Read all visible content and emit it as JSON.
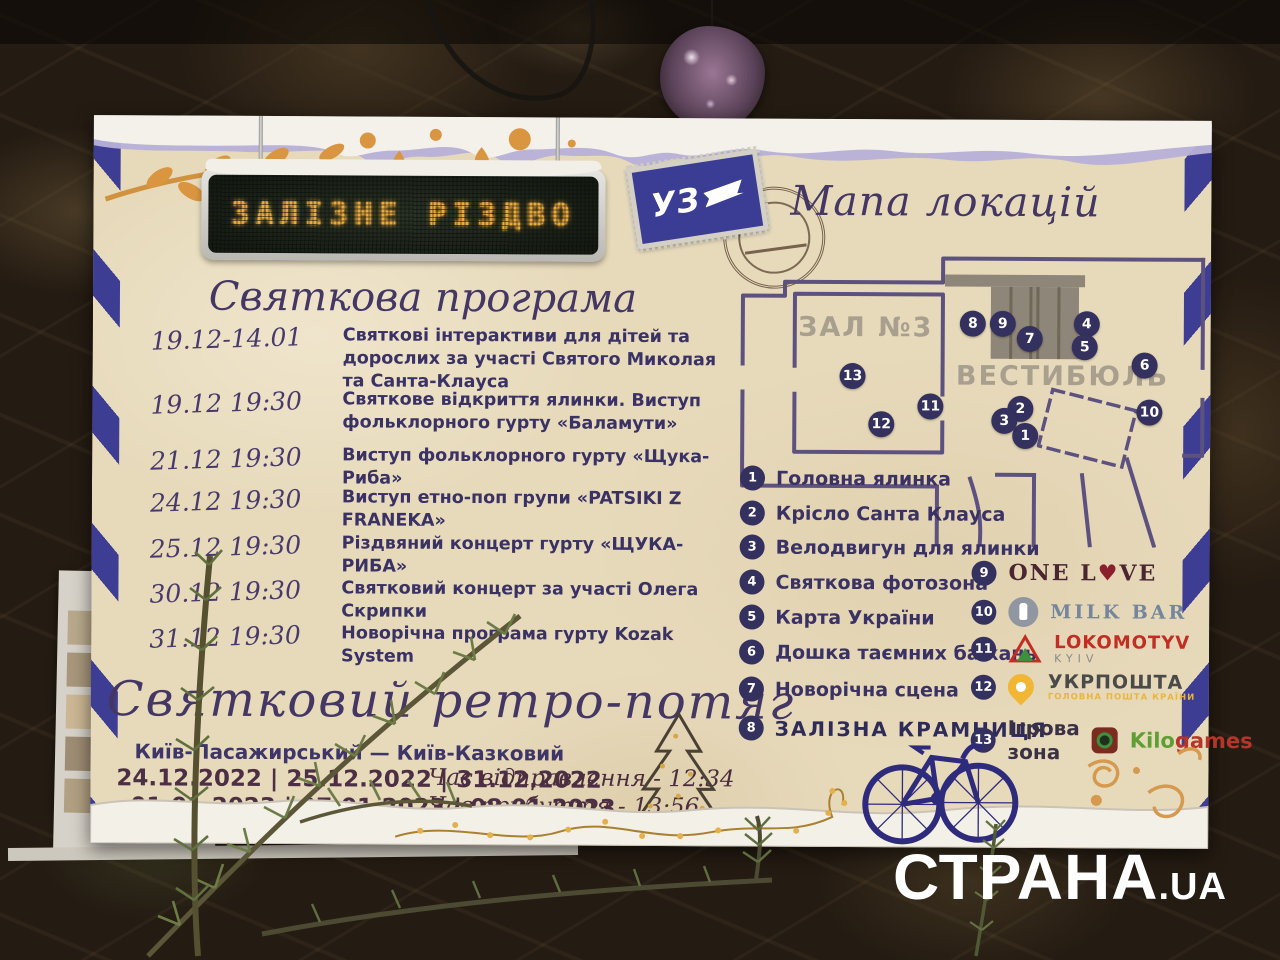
{
  "led_sign": {
    "text": "ЗАЛІЗНЕ РІЗДВО"
  },
  "stamp": {
    "label": "УЗ"
  },
  "map": {
    "title": "Мапа локацій",
    "hall_label": "ЗАЛ №3",
    "vestibule_label": "ВЕСТИБЮЛЬ",
    "markers": [
      "1",
      "2",
      "3",
      "4",
      "5",
      "6",
      "7",
      "8",
      "9",
      "10",
      "11",
      "12",
      "13"
    ]
  },
  "program": {
    "title": "Святкова програма",
    "items": [
      {
        "when": "19.12-14.01",
        "text": "Святкові інтерактиви для дітей та дорослих за участі Святого Миколая та Санта-Клауса"
      },
      {
        "when": "19.12 19:30",
        "text": "Святкове відкриття ялинки. Виступ фольклорного гурту «Баламути»"
      },
      {
        "when": "21.12 19:30",
        "text": "Виступ фольклорного гурту «Щука-Риба»"
      },
      {
        "when": "24.12 19:30",
        "text": "Виступ етно-поп групи «PATSIKI Z FRANEKA»"
      },
      {
        "when": "25.12 19:30",
        "text": "Різдвяний концерт гурту «ЩУКА-РИБА»"
      },
      {
        "when": "30.12 19:30",
        "text": "Святковий концерт за участі Олега Скрипки"
      },
      {
        "when": "31.12 19:30",
        "text": "Новорічна програма гурту Kozak System"
      }
    ]
  },
  "retro_train": {
    "title": "Святковий ретро-потяг",
    "route": "Київ-Пасажирський — Київ-Казковий",
    "dates_row1": "24.12.2022 | 25.12.2022 | 31.12.2022",
    "dates_row2": "01.01.2023 | 07.01.2023 | 08.01.2023",
    "departure": "Час відправлення - 12:34",
    "arrival": "Час прибуття - 13:56"
  },
  "legend": {
    "items": [
      {
        "num": "1",
        "label": "Головна ялинка"
      },
      {
        "num": "2",
        "label": "Крісло Санта Клауса"
      },
      {
        "num": "3",
        "label": "Велодвигун для ялинки"
      },
      {
        "num": "4",
        "label": "Святкова фотозона"
      },
      {
        "num": "5",
        "label": "Карта України"
      },
      {
        "num": "6",
        "label": "Дошка таємних бажань"
      },
      {
        "num": "7",
        "label": "Новорічна сцена"
      },
      {
        "num": "8",
        "label": "ЗАЛІЗНА КРАМНИЦЯ"
      }
    ]
  },
  "partners": {
    "one_love": {
      "num": "9",
      "p1": "ONE L",
      "heart": "♥",
      "p2": "VE"
    },
    "milk_bar": {
      "num": "10",
      "name": "MILK BAR"
    },
    "lokomotyv": {
      "num": "11",
      "name": "LOKOMOTYV",
      "sub": "KYIV"
    },
    "ukrposhta": {
      "num": "12",
      "name": "УКРПОШТА",
      "sub": "ГОЛОВНА ПОШТА КРАЇНИ"
    },
    "kilogames": {
      "num": "13",
      "prefix": "Ігрова зона",
      "word1": "Kilo",
      "word2": "games"
    }
  },
  "watermark": {
    "name": "СТРАНА",
    "suffix": ".UA"
  },
  "colors": {
    "poster_bg": "#e7dabb",
    "stripe_blue": "#3e3d94",
    "marker_navy": "#34315f",
    "led_amber": "#eaa93e",
    "heading_purple": "#453764",
    "text_indigo": "#3a3164",
    "dates_maroon": "#4c2f45",
    "ukrposhta_yellow": "#f0b634",
    "lokomotyv_red": "#c32d24",
    "kilo_green": "#5f9e33",
    "kilo_red": "#b5352a",
    "milkbar_blue": "#74859d",
    "onelove_maroon": "#4a2631",
    "orange_deco": "#d9953f"
  }
}
